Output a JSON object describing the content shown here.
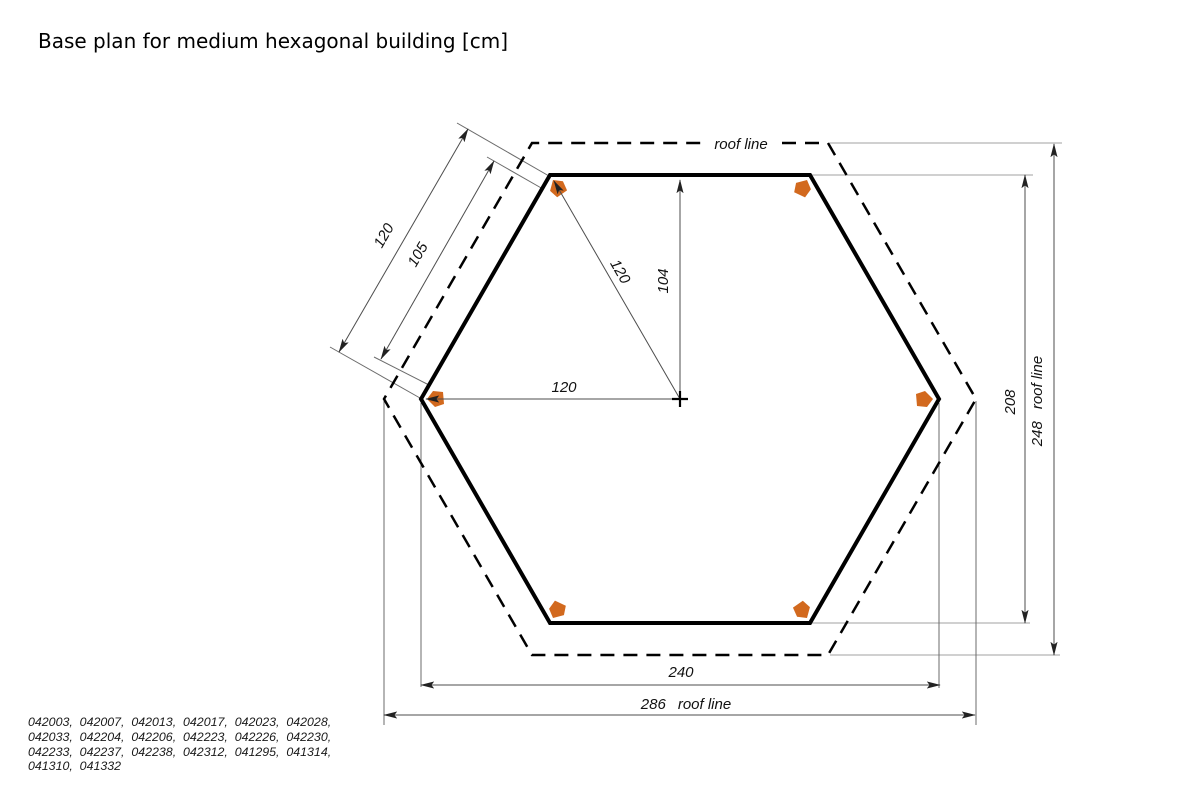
{
  "title": "Base plan for medium hexagonal building [cm]",
  "labels": {
    "roof_line": "roof line",
    "side": "120",
    "side_inner": "105",
    "radius": "120",
    "apothem": "104",
    "half_width": "120",
    "base_width": "240",
    "roof_width": "286",
    "height": "208",
    "roof_height": "248"
  },
  "colors": {
    "corner_marker": "#d2691e",
    "outline": "#000000"
  },
  "codes_lines": [
    "042003,  042007,  042013,  042017,  042023,  042028,",
    "042033,  042204,  042206,  042223,  042226,  042230,",
    "042233,  042237,  042238,  042312,  041295,  041314,",
    "041310,  041332"
  ]
}
